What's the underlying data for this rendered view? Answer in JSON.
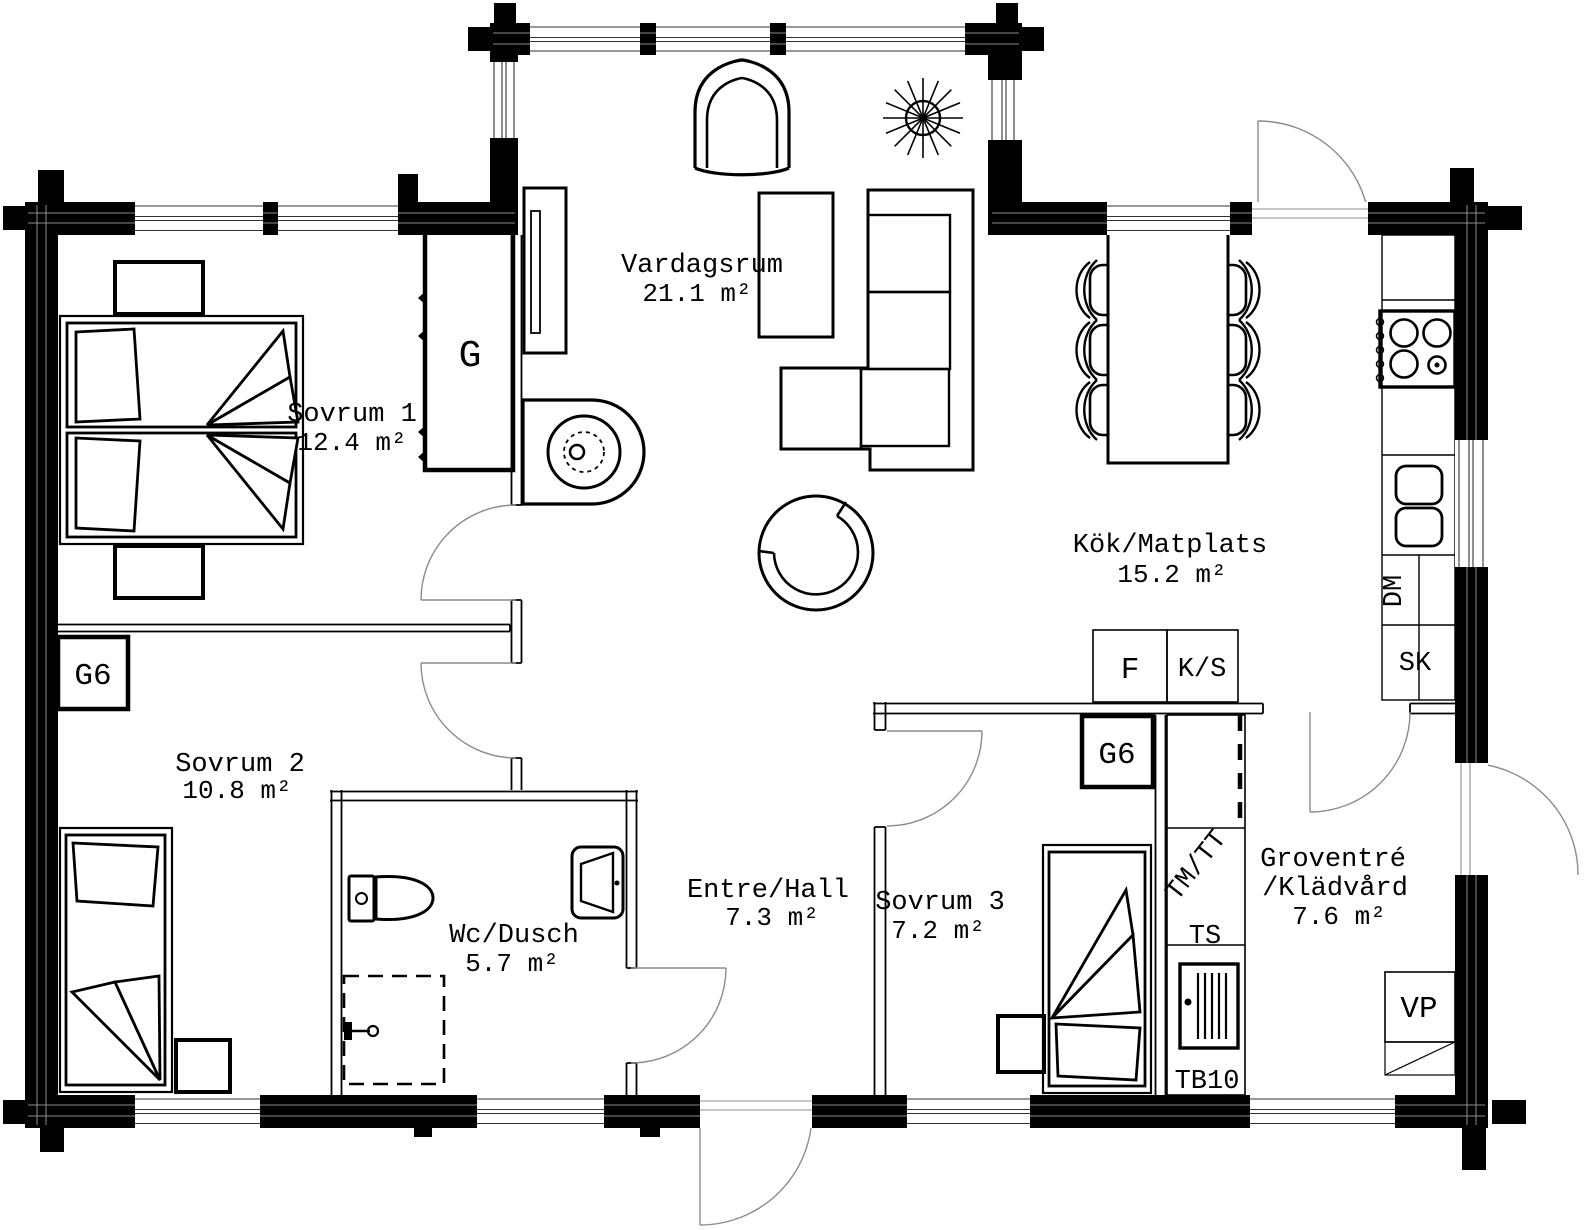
{
  "canvas": {
    "bg": "#ffffff",
    "wall_color": "#000000",
    "door_arc_color": "#8c8c8c"
  },
  "rooms": [
    {
      "id": "vardagsrum",
      "name": "Vardagsrum",
      "area": "21.1 m²"
    },
    {
      "id": "sovrum1",
      "name": "Sovrum 1",
      "area": "12.4 m²"
    },
    {
      "id": "kok_matplats",
      "name": "Kök/Matplats",
      "area": "15.2 m²"
    },
    {
      "id": "sovrum2",
      "name": "Sovrum 2",
      "area": "10.8 m²"
    },
    {
      "id": "wc_dusch",
      "name": "Wc/Dusch",
      "area": "5.7 m²"
    },
    {
      "id": "entre_hall",
      "name": "Entre/Hall",
      "area": "7.3 m²"
    },
    {
      "id": "sovrum3",
      "name": "Sovrum 3",
      "area": "7.2 m²"
    },
    {
      "id": "groventre",
      "name_line1": "Groventré",
      "name_line2": "/Klädvård",
      "area": "7.6 m²"
    }
  ],
  "fixtures": {
    "wardrobe_g": "G",
    "wardrobe_g6_sovrum2": "G6",
    "wardrobe_g6_sovrum3": "G6",
    "fridge": "F",
    "fridge_freezer": "K/S",
    "dishwasher": "DM",
    "tall_cabinet": "SK",
    "washer_dryer": "TM/TT",
    "drying_cabinet": "TS",
    "door_type": "TB10",
    "heat_pump": "VP"
  }
}
